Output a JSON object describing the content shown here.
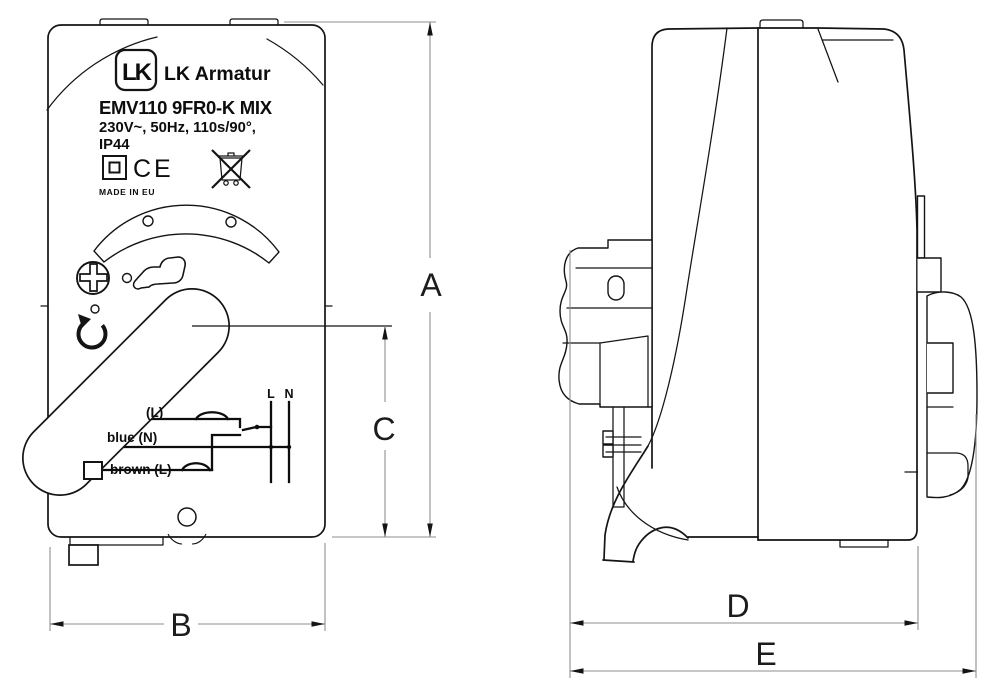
{
  "front_view": {
    "label_plate": {
      "logo_text": "LK",
      "brand": "LK Armatur",
      "model": "EMV110 9FR0-K MIX",
      "electrical_specs": "230V~, 50Hz, 110s/90°,",
      "protection_rating": "IP44",
      "ce_mark": "CE",
      "made_in": "MADE IN EU"
    },
    "wiring": {
      "terminal_live": "L",
      "terminal_neutral": "N",
      "wire_top": "(L)",
      "wire_middle": "blue (N)",
      "wire_bottom": "brown (L)"
    }
  },
  "dimensions": {
    "height": "A",
    "width": "B",
    "lever_center_height": "C",
    "body_depth": "D",
    "overall_depth": "E"
  },
  "icons": {
    "class2_insulation": "square-in-square",
    "ce_mark": "CE-letters",
    "weee": "crossed-out-wheelie-bin",
    "manual_adjust": "phillips-screw-head",
    "hand_operation": "pointing-hand",
    "rotation_direction": "counterclockwise-arrow"
  },
  "colors": {
    "line": "#141414",
    "dimension_line": "#8f8f8f",
    "background": "#ffffff"
  }
}
